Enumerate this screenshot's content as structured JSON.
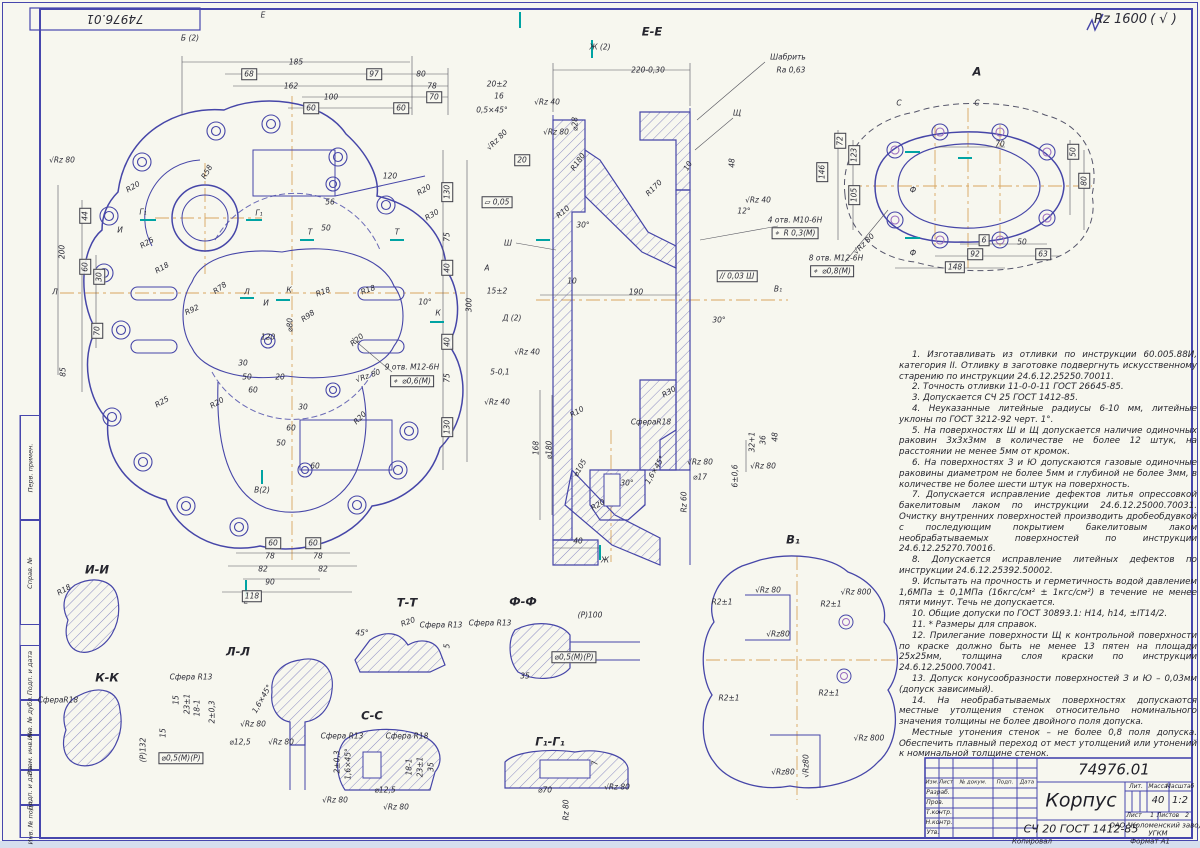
{
  "sheet": {
    "corner_number": "74976.01",
    "general_roughness": "Rz 1600",
    "general_roughness_suffix": "( √ )"
  },
  "left_margin": {
    "labels": [
      "Перв. примен.",
      "Справ. №",
      "Подп. и дата",
      "Инв. № дубл.",
      "Взам. инв. №",
      "Подп. и дата",
      "Инв. № подл."
    ]
  },
  "notes": [
    "1. Изготавливать из отливки по инструкции 60.005.88И, категория II. Отливку в заготовке подвергнуть искусственному старению по инструкции 24.6.12.25250.70011.",
    "2. Точность отливки 11-0-0-11 ГОСТ 26645-85.",
    "3. Допускается СЧ 25 ГОСТ 1412-85.",
    "4. Неуказанные литейные радиусы 6-10 мм, литейные уклоны по ГОСТ 3212-92 черт. 1°.",
    "5. На поверхностях Ш и Щ допускается наличие одиночных раковин 3х3х3мм в количестве не более 12 штук, на расстоянии не менее 5мм от кромок.",
    "6. На поверхностях З и Ю допускаются газовые одиночные раковины диаметром не более 5мм и глубиной не более 3мм, в количестве не более шести штук на поверхность.",
    "7. Допускается исправление дефектов литья опрессовкой бакелитовым лаком по инструкции 24.6.12.25000.70031. Очистку внутренних поверхностей производить дробеобдувкой с последующим покрытием бакелитовым лаком необрабатываемых поверхностей по инструкции 24.6.12.25270.70016.",
    "8. Допускается исправление литейных дефектов по инструкции 24.6.12.25392.50002.",
    "9. Испытать на прочность и герметичность водой давлением 1,6МПа ± 0,1МПа (16кгс/см² ± 1кгс/см²) в течение не менее пяти минут. Течь не допускается.",
    "10. Общие допуски по ГОСТ 30893.1: Н14, h14, ±IT14/2.",
    "11. * Размеры для справок.",
    "12. Прилегание поверхности Щ к контрольной поверхности по краске должно быть не менее 13 пятен на площади 25х25мм, толщина слоя краски по инструкции 24.6.12.25000.70041.",
    "13. Допуск конусообразности поверхностей З и Ю – 0,03мм (допуск зависимый).",
    "14. На необрабатываемых поверхностях допускаются местные утолщения стенок относительно номинального значения толщины не более двойного поля допуска.",
    "Местные утонения стенок – не более 0,8 поля допуска. Обеспечить плавный переход от мест утолщений или утонений к номинальной толщине стенок."
  ],
  "title_block": {
    "number": "74976.01",
    "name": "Корпус",
    "material": "СЧ 20 ГОСТ 1412-85",
    "col_izm": "Изм.",
    "col_list": "Лист",
    "col_doc": "№ докум.",
    "col_podp": "Подп.",
    "col_data": "Дата",
    "row_razrab": "Разраб.",
    "row_prov": "Пров.",
    "row_tkontr": "Т.контр.",
    "row_nkontr": "Н.контр.",
    "row_utv": "Утв.",
    "lit_label": "Лит.",
    "mass_label": "Масса",
    "scale_label": "Масштаб",
    "mass": "40",
    "scale": "1:2",
    "sheet_label": "Лист",
    "sheet": "1",
    "sheets_label": "Листов",
    "sheets": "2",
    "company_line1": "ОАО \"Коломенский завод\"",
    "company_line2": "УГКМ",
    "copied": "Копировал",
    "format": "Формат  А1"
  },
  "colors": {
    "line": "#4646a8",
    "thin": "#6a6ab8",
    "dim": "#55555e",
    "centerline": "#d8a55f",
    "accent_teal": "#00a3a3",
    "accent_purple": "#9a6cc0",
    "paper": "#f7f7ef"
  },
  "annotations": [
    {
      "x": 190,
      "y": 38,
      "t": "Б (2)"
    },
    {
      "x": 263,
      "y": 15,
      "t": "Е"
    },
    {
      "x": 246,
      "y": 601,
      "t": "Е"
    },
    {
      "x": 296,
      "y": 62,
      "t": "185"
    },
    {
      "x": 249,
      "y": 74,
      "t": "68",
      "c": "boxed"
    },
    {
      "x": 374,
      "y": 74,
      "t": "97",
      "c": "boxed"
    },
    {
      "x": 421,
      "y": 74,
      "t": "80"
    },
    {
      "x": 291,
      "y": 86,
      "t": "162"
    },
    {
      "x": 432,
      "y": 86,
      "t": "78"
    },
    {
      "x": 331,
      "y": 97,
      "t": "100"
    },
    {
      "x": 434,
      "y": 97,
      "t": "70",
      "c": "boxed"
    },
    {
      "x": 311,
      "y": 108,
      "t": "60",
      "c": "boxed"
    },
    {
      "x": 401,
      "y": 108,
      "t": "60",
      "c": "boxed"
    },
    {
      "x": 62,
      "y": 160,
      "t": "√Rz 80"
    },
    {
      "x": 133,
      "y": 187,
      "t": "R20",
      "r": -30
    },
    {
      "x": 143,
      "y": 212,
      "t": "Г₁"
    },
    {
      "x": 259,
      "y": 213,
      "t": "Г₁"
    },
    {
      "x": 120,
      "y": 230,
      "t": "И"
    },
    {
      "x": 147,
      "y": 243,
      "t": "R25",
      "r": -30
    },
    {
      "x": 162,
      "y": 268,
      "t": "R18",
      "r": -30
    },
    {
      "x": 55,
      "y": 292,
      "t": "Л"
    },
    {
      "x": 247,
      "y": 292,
      "t": "Л"
    },
    {
      "x": 266,
      "y": 303,
      "t": "И"
    },
    {
      "x": 289,
      "y": 290,
      "t": "К"
    },
    {
      "x": 438,
      "y": 313,
      "t": "К"
    },
    {
      "x": 207,
      "y": 172,
      "t": "R58",
      "r": -60
    },
    {
      "x": 390,
      "y": 176,
      "t": "120"
    },
    {
      "x": 424,
      "y": 190,
      "t": "R20",
      "r": -30
    },
    {
      "x": 432,
      "y": 215,
      "t": "R30",
      "r": -30
    },
    {
      "x": 330,
      "y": 202,
      "t": "56"
    },
    {
      "x": 326,
      "y": 228,
      "t": "50"
    },
    {
      "x": 310,
      "y": 232,
      "t": "Т"
    },
    {
      "x": 397,
      "y": 232,
      "t": "Т"
    },
    {
      "x": 192,
      "y": 310,
      "t": "R92",
      "r": -25
    },
    {
      "x": 220,
      "y": 288,
      "t": "R78",
      "r": -35
    },
    {
      "x": 308,
      "y": 316,
      "t": "R98",
      "r": -35
    },
    {
      "x": 323,
      "y": 292,
      "t": "R18",
      "r": -20
    },
    {
      "x": 368,
      "y": 290,
      "t": "R18",
      "r": -20
    },
    {
      "x": 357,
      "y": 340,
      "t": "R20",
      "r": -40
    },
    {
      "x": 425,
      "y": 302,
      "t": "10°"
    },
    {
      "x": 290,
      "y": 325,
      "t": "⌀80",
      "r": -90
    },
    {
      "x": 268,
      "y": 337,
      "t": "120"
    },
    {
      "x": 243,
      "y": 363,
      "t": "30"
    },
    {
      "x": 247,
      "y": 377,
      "t": "50"
    },
    {
      "x": 280,
      "y": 377,
      "t": "20"
    },
    {
      "x": 253,
      "y": 390,
      "t": "60"
    },
    {
      "x": 412,
      "y": 367,
      "t": "9 отв. М12-6Н"
    },
    {
      "x": 412,
      "y": 381,
      "t": "⌖  ⌀0,6(М)",
      "c": "boxed"
    },
    {
      "x": 368,
      "y": 376,
      "t": "√Rz 80",
      "r": -20
    },
    {
      "x": 447,
      "y": 192,
      "t": "130",
      "c": "boxed",
      "r": -90
    },
    {
      "x": 447,
      "y": 237,
      "t": "75",
      "r": -90
    },
    {
      "x": 447,
      "y": 268,
      "t": "40",
      "c": "boxed",
      "r": -90
    },
    {
      "x": 447,
      "y": 342,
      "t": "40",
      "c": "boxed",
      "r": -90
    },
    {
      "x": 447,
      "y": 378,
      "t": "75",
      "r": -90
    },
    {
      "x": 447,
      "y": 427,
      "t": "130",
      "c": "boxed",
      "r": -90
    },
    {
      "x": 469,
      "y": 305,
      "t": "300",
      "r": -90
    },
    {
      "x": 62,
      "y": 252,
      "t": "200",
      "r": -90
    },
    {
      "x": 85,
      "y": 216,
      "t": "44",
      "c": "boxed",
      "r": -90
    },
    {
      "x": 85,
      "y": 267,
      "t": "60",
      "c": "boxed",
      "r": -90
    },
    {
      "x": 99,
      "y": 277,
      "t": "30",
      "c": "boxed",
      "r": -90
    },
    {
      "x": 97,
      "y": 331,
      "t": "70",
      "c": "boxed",
      "r": -90
    },
    {
      "x": 63,
      "y": 372,
      "t": "85",
      "r": -90
    },
    {
      "x": 162,
      "y": 402,
      "t": "R25",
      "r": -30
    },
    {
      "x": 217,
      "y": 403,
      "t": "R20",
      "r": -30
    },
    {
      "x": 360,
      "y": 418,
      "t": "R20",
      "r": -45
    },
    {
      "x": 262,
      "y": 490,
      "t": "В(2)"
    },
    {
      "x": 273,
      "y": 543,
      "t": "60",
      "c": "boxed"
    },
    {
      "x": 313,
      "y": 543,
      "t": "60",
      "c": "boxed"
    },
    {
      "x": 270,
      "y": 556,
      "t": "78"
    },
    {
      "x": 318,
      "y": 556,
      "t": "78"
    },
    {
      "x": 263,
      "y": 569,
      "t": "82"
    },
    {
      "x": 323,
      "y": 569,
      "t": "82"
    },
    {
      "x": 270,
      "y": 582,
      "t": "90"
    },
    {
      "x": 252,
      "y": 596,
      "t": "118",
      "c": "boxed"
    },
    {
      "x": 281,
      "y": 443,
      "t": "50"
    },
    {
      "x": 291,
      "y": 428,
      "t": "60"
    },
    {
      "x": 303,
      "y": 407,
      "t": "30"
    },
    {
      "x": 315,
      "y": 466,
      "t": "60"
    },
    {
      "x": 652,
      "y": 32,
      "t": "Е-Е",
      "c": "title"
    },
    {
      "x": 600,
      "y": 47,
      "t": "Ж (2)"
    },
    {
      "x": 648,
      "y": 70,
      "t": "220-0,30"
    },
    {
      "x": 788,
      "y": 57,
      "t": "Шабрить"
    },
    {
      "x": 791,
      "y": 70,
      "t": "Ra 0,63"
    },
    {
      "x": 737,
      "y": 113,
      "t": "Щ"
    },
    {
      "x": 497,
      "y": 84,
      "t": "20±2"
    },
    {
      "x": 499,
      "y": 96,
      "t": "16"
    },
    {
      "x": 492,
      "y": 110,
      "t": "0,5×45°"
    },
    {
      "x": 547,
      "y": 102,
      "t": "√Rz 40"
    },
    {
      "x": 556,
      "y": 132,
      "t": "√Rz 80"
    },
    {
      "x": 575,
      "y": 124,
      "t": "⌀28",
      "r": -90
    },
    {
      "x": 497,
      "y": 140,
      "t": "√Rz 80",
      "r": -45
    },
    {
      "x": 522,
      "y": 160,
      "t": "20",
      "c": "boxed"
    },
    {
      "x": 578,
      "y": 162,
      "t": "R180",
      "r": -55
    },
    {
      "x": 688,
      "y": 166,
      "t": "10",
      "r": -60
    },
    {
      "x": 654,
      "y": 188,
      "t": "R170",
      "r": -45
    },
    {
      "x": 732,
      "y": 163,
      "t": "48",
      "r": -90
    },
    {
      "x": 758,
      "y": 200,
      "t": "√Rz 40"
    },
    {
      "x": 744,
      "y": 211,
      "t": "12°"
    },
    {
      "x": 795,
      "y": 220,
      "t": "4 отв. М10-6Н"
    },
    {
      "x": 795,
      "y": 233,
      "t": "⌖  R 0,3(М)",
      "c": "boxed"
    },
    {
      "x": 497,
      "y": 202,
      "t": "▱ 0,05",
      "c": "boxed"
    },
    {
      "x": 508,
      "y": 243,
      "t": "Ш"
    },
    {
      "x": 583,
      "y": 225,
      "t": "30°"
    },
    {
      "x": 563,
      "y": 212,
      "t": "R10",
      "r": -40
    },
    {
      "x": 487,
      "y": 268,
      "t": "А"
    },
    {
      "x": 572,
      "y": 281,
      "t": "10"
    },
    {
      "x": 497,
      "y": 291,
      "t": "15±2"
    },
    {
      "x": 636,
      "y": 292,
      "t": "190"
    },
    {
      "x": 512,
      "y": 318,
      "t": "Д (2)"
    },
    {
      "x": 737,
      "y": 276,
      "t": "// 0,03 Ш",
      "c": "boxed"
    },
    {
      "x": 778,
      "y": 289,
      "t": "В₁"
    },
    {
      "x": 719,
      "y": 320,
      "t": "30°"
    },
    {
      "x": 527,
      "y": 352,
      "t": "√Rz 40"
    },
    {
      "x": 500,
      "y": 372,
      "t": "5-0,1"
    },
    {
      "x": 497,
      "y": 402,
      "t": "√Rz 40"
    },
    {
      "x": 577,
      "y": 412,
      "t": "R10",
      "r": -30
    },
    {
      "x": 669,
      "y": 392,
      "t": "R30",
      "r": -30
    },
    {
      "x": 651,
      "y": 422,
      "t": "СфераR18"
    },
    {
      "x": 536,
      "y": 448,
      "t": "168",
      "r": -90
    },
    {
      "x": 549,
      "y": 450,
      "t": "⌀180",
      "r": -90
    },
    {
      "x": 580,
      "y": 468,
      "t": "⌀105",
      "r": -60
    },
    {
      "x": 598,
      "y": 505,
      "t": "R20",
      "r": -30
    },
    {
      "x": 578,
      "y": 541,
      "t": "40"
    },
    {
      "x": 605,
      "y": 560,
      "t": "Ж"
    },
    {
      "x": 627,
      "y": 483,
      "t": "30°"
    },
    {
      "x": 655,
      "y": 470,
      "t": "1,6×45°",
      "r": -60
    },
    {
      "x": 700,
      "y": 462,
      "t": "√Rz 80"
    },
    {
      "x": 700,
      "y": 477,
      "t": "⌀17"
    },
    {
      "x": 735,
      "y": 476,
      "t": "6±0,6",
      "r": -90
    },
    {
      "x": 684,
      "y": 502,
      "t": "Rz 60",
      "r": -90
    },
    {
      "x": 763,
      "y": 466,
      "t": "√Rz 80"
    },
    {
      "x": 752,
      "y": 442,
      "t": "32+1",
      "r": -90
    },
    {
      "x": 763,
      "y": 440,
      "t": "36",
      "r": -90
    },
    {
      "x": 775,
      "y": 437,
      "t": "48",
      "r": -90
    },
    {
      "x": 977,
      "y": 72,
      "t": "А",
      "c": "title"
    },
    {
      "x": 1000,
      "y": 144,
      "t": "70"
    },
    {
      "x": 899,
      "y": 103,
      "t": "С"
    },
    {
      "x": 977,
      "y": 103,
      "t": "С"
    },
    {
      "x": 840,
      "y": 141,
      "t": "72",
      "c": "boxed",
      "r": -90
    },
    {
      "x": 854,
      "y": 155,
      "t": "123",
      "c": "boxed",
      "r": -90
    },
    {
      "x": 822,
      "y": 172,
      "t": "146",
      "c": "boxed",
      "r": -90
    },
    {
      "x": 854,
      "y": 195,
      "t": "105",
      "c": "boxed",
      "r": -90
    },
    {
      "x": 1073,
      "y": 152,
      "t": "50",
      "c": "boxed",
      "r": -90
    },
    {
      "x": 1084,
      "y": 181,
      "t": "80",
      "c": "boxed",
      "r": -90
    },
    {
      "x": 984,
      "y": 240,
      "t": "6",
      "c": "boxed"
    },
    {
      "x": 1022,
      "y": 242,
      "t": "50"
    },
    {
      "x": 975,
      "y": 254,
      "t": "92",
      "c": "boxed"
    },
    {
      "x": 1043,
      "y": 254,
      "t": "63",
      "c": "boxed"
    },
    {
      "x": 955,
      "y": 267,
      "t": "148",
      "c": "boxed"
    },
    {
      "x": 836,
      "y": 258,
      "t": "8 отв. М12-6Н"
    },
    {
      "x": 832,
      "y": 271,
      "t": "⌖  ⌀0,8(М)",
      "c": "boxed"
    },
    {
      "x": 864,
      "y": 244,
      "t": "√Rz 80",
      "r": -45
    },
    {
      "x": 913,
      "y": 190,
      "t": "Ф"
    },
    {
      "x": 913,
      "y": 253,
      "t": "Ф"
    },
    {
      "x": 793,
      "y": 540,
      "t": "В₁",
      "c": "title"
    },
    {
      "x": 768,
      "y": 590,
      "t": "√Rz 80"
    },
    {
      "x": 856,
      "y": 592,
      "t": "√Rz 800"
    },
    {
      "x": 722,
      "y": 602,
      "t": "R2±1"
    },
    {
      "x": 831,
      "y": 604,
      "t": "R2±1"
    },
    {
      "x": 778,
      "y": 634,
      "t": "√Rz80"
    },
    {
      "x": 729,
      "y": 698,
      "t": "R2±1"
    },
    {
      "x": 829,
      "y": 693,
      "t": "R2±1"
    },
    {
      "x": 869,
      "y": 738,
      "t": "√Rz 800"
    },
    {
      "x": 783,
      "y": 772,
      "t": "√Rz80"
    },
    {
      "x": 806,
      "y": 766,
      "t": "√Rz80",
      "r": -90
    },
    {
      "x": 97,
      "y": 570,
      "t": "И-И",
      "c": "title"
    },
    {
      "x": 64,
      "y": 590,
      "t": "R18",
      "r": -30
    },
    {
      "x": 107,
      "y": 678,
      "t": "К-К",
      "c": "title"
    },
    {
      "x": 58,
      "y": 700,
      "t": "СфераR18"
    },
    {
      "x": 163,
      "y": 733,
      "t": "15",
      "r": -90
    },
    {
      "x": 238,
      "y": 652,
      "t": "Л-Л",
      "c": "title"
    },
    {
      "x": 191,
      "y": 677,
      "t": "Сфера R13"
    },
    {
      "x": 176,
      "y": 700,
      "t": "15",
      "r": -90
    },
    {
      "x": 187,
      "y": 704,
      "t": "23±1",
      "r": -90
    },
    {
      "x": 197,
      "y": 708,
      "t": "18-1",
      "r": -90
    },
    {
      "x": 212,
      "y": 712,
      "t": "2±0,3",
      "r": -90
    },
    {
      "x": 143,
      "y": 750,
      "t": "(Р)132",
      "r": -90
    },
    {
      "x": 262,
      "y": 699,
      "t": "1,6×45°",
      "r": -60
    },
    {
      "x": 253,
      "y": 724,
      "t": "√Rz 80"
    },
    {
      "x": 240,
      "y": 742,
      "t": "⌀12,5"
    },
    {
      "x": 281,
      "y": 742,
      "t": "√Rz 80"
    },
    {
      "x": 181,
      "y": 758,
      "t": "⌀0,5(М)(Р)",
      "c": "boxed"
    },
    {
      "x": 407,
      "y": 603,
      "t": "Т-Т",
      "c": "title"
    },
    {
      "x": 362,
      "y": 633,
      "t": "45°"
    },
    {
      "x": 408,
      "y": 622,
      "t": "R20",
      "r": -20
    },
    {
      "x": 441,
      "y": 625,
      "t": "Сфера R13"
    },
    {
      "x": 447,
      "y": 646,
      "t": "5",
      "r": -90
    },
    {
      "x": 523,
      "y": 602,
      "t": "Ф-Ф",
      "c": "title"
    },
    {
      "x": 490,
      "y": 623,
      "t": "Сфера R13"
    },
    {
      "x": 590,
      "y": 615,
      "t": "(Р)100"
    },
    {
      "x": 574,
      "y": 657,
      "t": "⌀0,5(М)(Р)",
      "c": "boxed"
    },
    {
      "x": 525,
      "y": 676,
      "t": "35"
    },
    {
      "x": 372,
      "y": 716,
      "t": "С-С",
      "c": "title"
    },
    {
      "x": 342,
      "y": 736,
      "t": "Сфера R13"
    },
    {
      "x": 407,
      "y": 736,
      "t": "Сфера R18"
    },
    {
      "x": 337,
      "y": 762,
      "t": "2±0,3",
      "r": -90
    },
    {
      "x": 348,
      "y": 764,
      "t": "1,6×45°",
      "r": -90
    },
    {
      "x": 409,
      "y": 767,
      "t": "18-1",
      "r": -90
    },
    {
      "x": 420,
      "y": 767,
      "t": "23±1",
      "r": -90
    },
    {
      "x": 431,
      "y": 767,
      "t": "35",
      "r": -90
    },
    {
      "x": 335,
      "y": 800,
      "t": "√Rz 80"
    },
    {
      "x": 385,
      "y": 790,
      "t": "⌀12,5"
    },
    {
      "x": 396,
      "y": 807,
      "t": "√Rz 80"
    },
    {
      "x": 550,
      "y": 742,
      "t": "Г₁-Г₁",
      "c": "title"
    },
    {
      "x": 595,
      "y": 763,
      "t": "7",
      "r": -90
    },
    {
      "x": 545,
      "y": 790,
      "t": "⌀70"
    },
    {
      "x": 617,
      "y": 787,
      "t": "√Rz 80"
    },
    {
      "x": 566,
      "y": 810,
      "t": "Rz 80",
      "r": -90
    }
  ]
}
